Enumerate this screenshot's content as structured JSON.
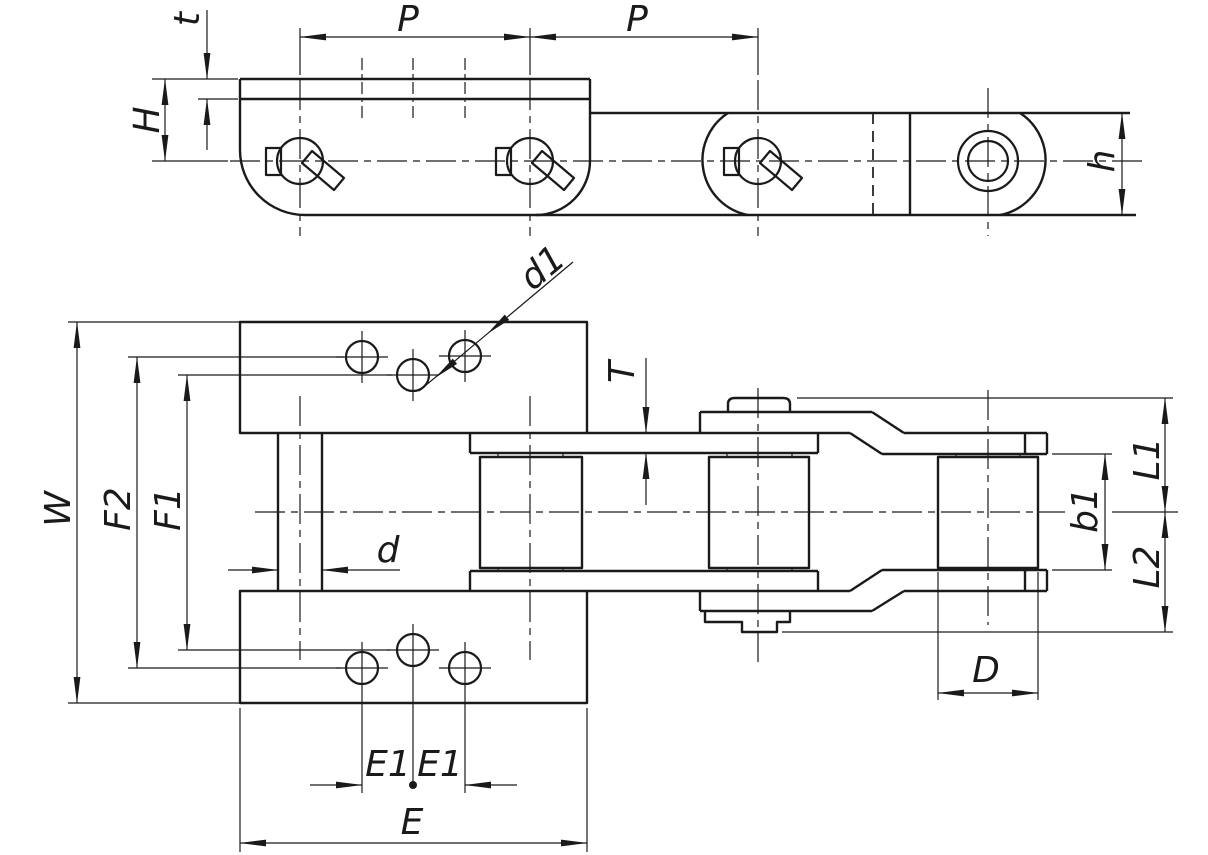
{
  "drawing": {
    "colors": {
      "background": "#ffffff",
      "line": "#1a1a1a"
    },
    "labels": {
      "side": {
        "t": "t",
        "H": "H",
        "P_left": "P",
        "P_right": "P",
        "h": "h"
      },
      "plan": {
        "d1": "d1",
        "T": "T",
        "W": "W",
        "F2": "F2",
        "F1": "F1",
        "d": "d",
        "b1": "b1",
        "L1": "L1",
        "L2": "L2",
        "D": "D",
        "E1_left": "E1",
        "E1_right": "E1",
        "E": "E"
      }
    }
  }
}
